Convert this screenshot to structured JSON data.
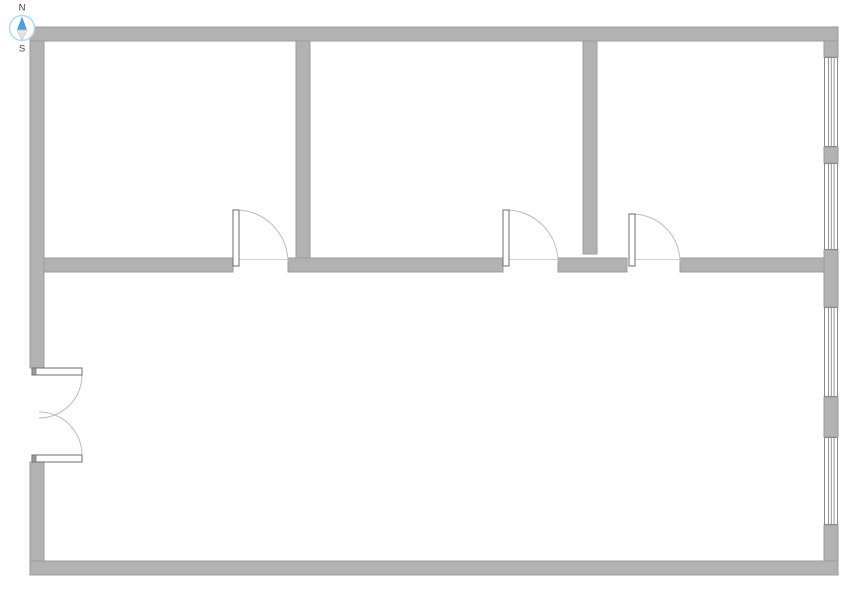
{
  "meta": {
    "width": 853,
    "height": 590,
    "background": "#ffffff"
  },
  "compass": {
    "north_label": "N",
    "south_label": "S",
    "cx": 22,
    "cy": 28,
    "r": 12.5,
    "ring_color": "#b5dbf2",
    "ring_fill": "#ffffff",
    "north_needle_color": "#4f9fd9",
    "south_needle_color": "#e4e4e4",
    "south_needle_stroke": "#c9c9c9",
    "label_color": "#3d3d3d"
  },
  "plan": {
    "wall_fill": "#b2b2b2",
    "wall_stroke": "#9c9c9c",
    "door_leaf_fill": "#ffffff",
    "door_leaf_stroke": "#6e6e6e",
    "door_hinge_cap_fill": "#9a9a9a",
    "door_arc_color": "#bcbcbc",
    "threshold_color": "#d4d4d4",
    "window_fill": "#ffffff",
    "window_stroke": "#8a8a8a",
    "walls": [
      {
        "name": "exterior-wall-north",
        "x": 30,
        "y": 27,
        "w": 808,
        "h": 14
      },
      {
        "name": "exterior-wall-south",
        "x": 30,
        "y": 561,
        "w": 808,
        "h": 14
      },
      {
        "name": "exterior-wall-west-upper",
        "x": 30,
        "y": 41,
        "w": 14,
        "h": 327
      },
      {
        "name": "exterior-wall-west-lower",
        "x": 30,
        "y": 462,
        "w": 14,
        "h": 99
      },
      {
        "name": "exterior-wall-east-segment-1",
        "x": 824,
        "y": 41,
        "w": 14,
        "h": 16
      },
      {
        "name": "exterior-wall-east-segment-2",
        "x": 824,
        "y": 147,
        "w": 14,
        "h": 16
      },
      {
        "name": "exterior-wall-east-segment-3",
        "x": 824,
        "y": 250,
        "w": 14,
        "h": 57
      },
      {
        "name": "exterior-wall-east-segment-4",
        "x": 824,
        "y": 397,
        "w": 14,
        "h": 40
      },
      {
        "name": "exterior-wall-east-segment-5",
        "x": 824,
        "y": 525,
        "w": 14,
        "h": 36
      },
      {
        "name": "interior-wall-horizontal-1",
        "x": 44,
        "y": 258,
        "w": 189,
        "h": 14
      },
      {
        "name": "interior-wall-horizontal-2",
        "x": 288,
        "y": 258,
        "w": 215,
        "h": 14
      },
      {
        "name": "interior-wall-horizontal-3",
        "x": 558,
        "y": 258,
        "w": 69,
        "h": 14
      },
      {
        "name": "interior-wall-horizontal-4",
        "x": 680,
        "y": 258,
        "w": 144,
        "h": 14
      },
      {
        "name": "interior-wall-vertical-1",
        "x": 296,
        "y": 41,
        "w": 14,
        "h": 217
      },
      {
        "name": "interior-wall-vertical-2",
        "x": 583,
        "y": 41,
        "w": 14,
        "h": 213
      }
    ],
    "windows": [
      {
        "name": "window-1",
        "x": 824,
        "y": 57,
        "w": 14,
        "h": 90
      },
      {
        "name": "window-2",
        "x": 824,
        "y": 163,
        "w": 14,
        "h": 87
      },
      {
        "name": "window-3",
        "x": 824,
        "y": 307,
        "w": 14,
        "h": 90
      },
      {
        "name": "window-4",
        "x": 824,
        "y": 437,
        "w": 14,
        "h": 88
      }
    ],
    "doors": [
      {
        "name": "door-1",
        "leaf": {
          "x": 233,
          "y": 210,
          "w": 6,
          "h": 56
        },
        "arc": "M 236 210 A 52 52 0 0 1 288 262",
        "threshold": {
          "x1": 239,
          "y1": 259.5,
          "x2": 288,
          "y2": 259.5
        }
      },
      {
        "name": "door-2",
        "leaf": {
          "x": 503,
          "y": 210,
          "w": 6,
          "h": 56
        },
        "arc": "M 506 210 A 52 52 0 0 1 558 262",
        "threshold": {
          "x1": 509,
          "y1": 259.5,
          "x2": 558,
          "y2": 259.5
        }
      },
      {
        "name": "door-3",
        "leaf": {
          "x": 629,
          "y": 214,
          "w": 6,
          "h": 52
        },
        "arc": "M 632 214 A 48 48 0 0 1 680 262",
        "threshold": {
          "x1": 635,
          "y1": 259.5,
          "x2": 680,
          "y2": 259.5
        }
      }
    ],
    "double_door": {
      "name": "entry-double-door",
      "leaves": [
        {
          "name": "entry-double-door-leaf-top",
          "x": 32,
          "y": 368,
          "w": 50,
          "h": 7,
          "cap": {
            "x": 32,
            "y": 368,
            "w": 4,
            "h": 7
          }
        },
        {
          "name": "entry-double-door-leaf-bottom",
          "x": 32,
          "y": 455,
          "w": 50,
          "h": 7,
          "cap": {
            "x": 32,
            "y": 455,
            "w": 4,
            "h": 7
          }
        }
      ],
      "arcs": [
        {
          "name": "entry-double-door-arc-top",
          "d": "M 82 375 A 43 43 0 0 1 39 418"
        },
        {
          "name": "entry-double-door-arc-bottom",
          "d": "M 82 455 A 43 43 0 0 0 39 412"
        }
      ]
    }
  }
}
